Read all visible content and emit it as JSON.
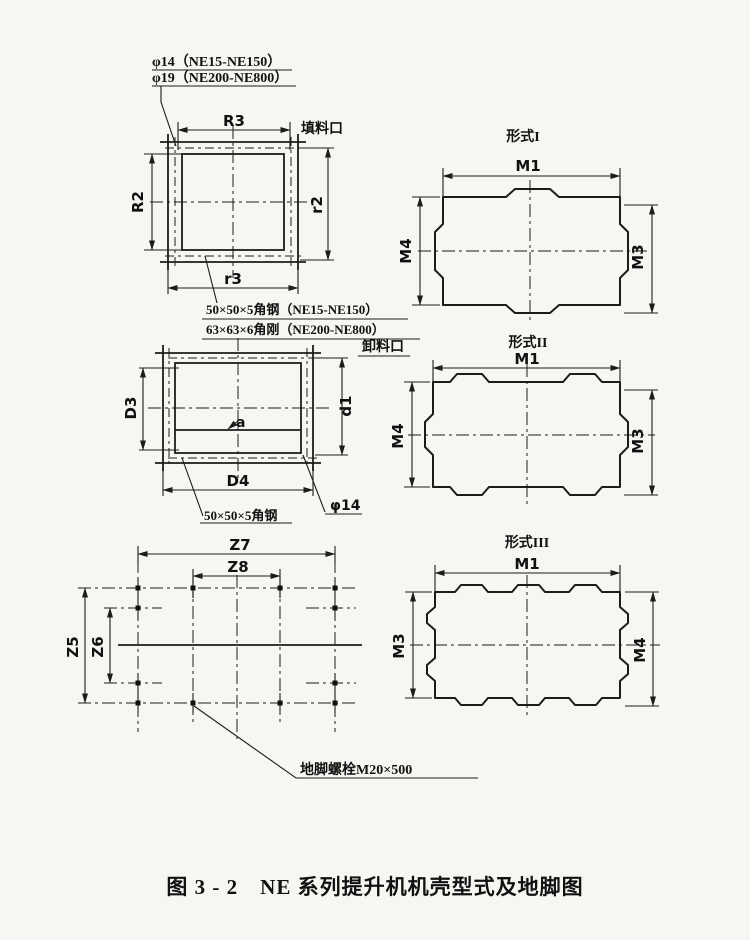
{
  "figure": {
    "caption": "图 3 - 2　NE 系列提升机机壳型式及地脚图"
  },
  "notes": {
    "hole_line1": "φ14（NE15-NE150）",
    "hole_line2": "φ19（NE200-NE800）",
    "angle_line1": "50×50×5角钢（NE15-NE150）",
    "angle_line2": "63×63×6角刚（NE200-NE800）",
    "angle_small": "50×50×5角钢",
    "anchor_bolt": "地脚螺栓M20×500"
  },
  "square_flange": {
    "port_label": "填料口",
    "dims": {
      "top": "R3",
      "left": "R2",
      "right": "r2",
      "bottom": "r3"
    }
  },
  "rect_flange": {
    "port_label": "卸料口",
    "dims": {
      "left": "D3",
      "right": "d1",
      "bottom": "D4",
      "offset": "a",
      "hole": "φ14"
    }
  },
  "foundation": {
    "dims": {
      "top_outer": "Z7",
      "top_inner": "Z8",
      "left_outer": "Z5",
      "left_inner": "Z6"
    }
  },
  "forms": [
    {
      "title": "形式I",
      "dim_top": "M1",
      "dim_left": "M4",
      "dim_right": "M3"
    },
    {
      "title": "形式II",
      "dim_top": "M1",
      "dim_left": "M4",
      "dim_right": "M3"
    },
    {
      "title": "形式III",
      "dim_top": "M1",
      "dim_left": "M3",
      "dim_right": "M4"
    }
  ]
}
